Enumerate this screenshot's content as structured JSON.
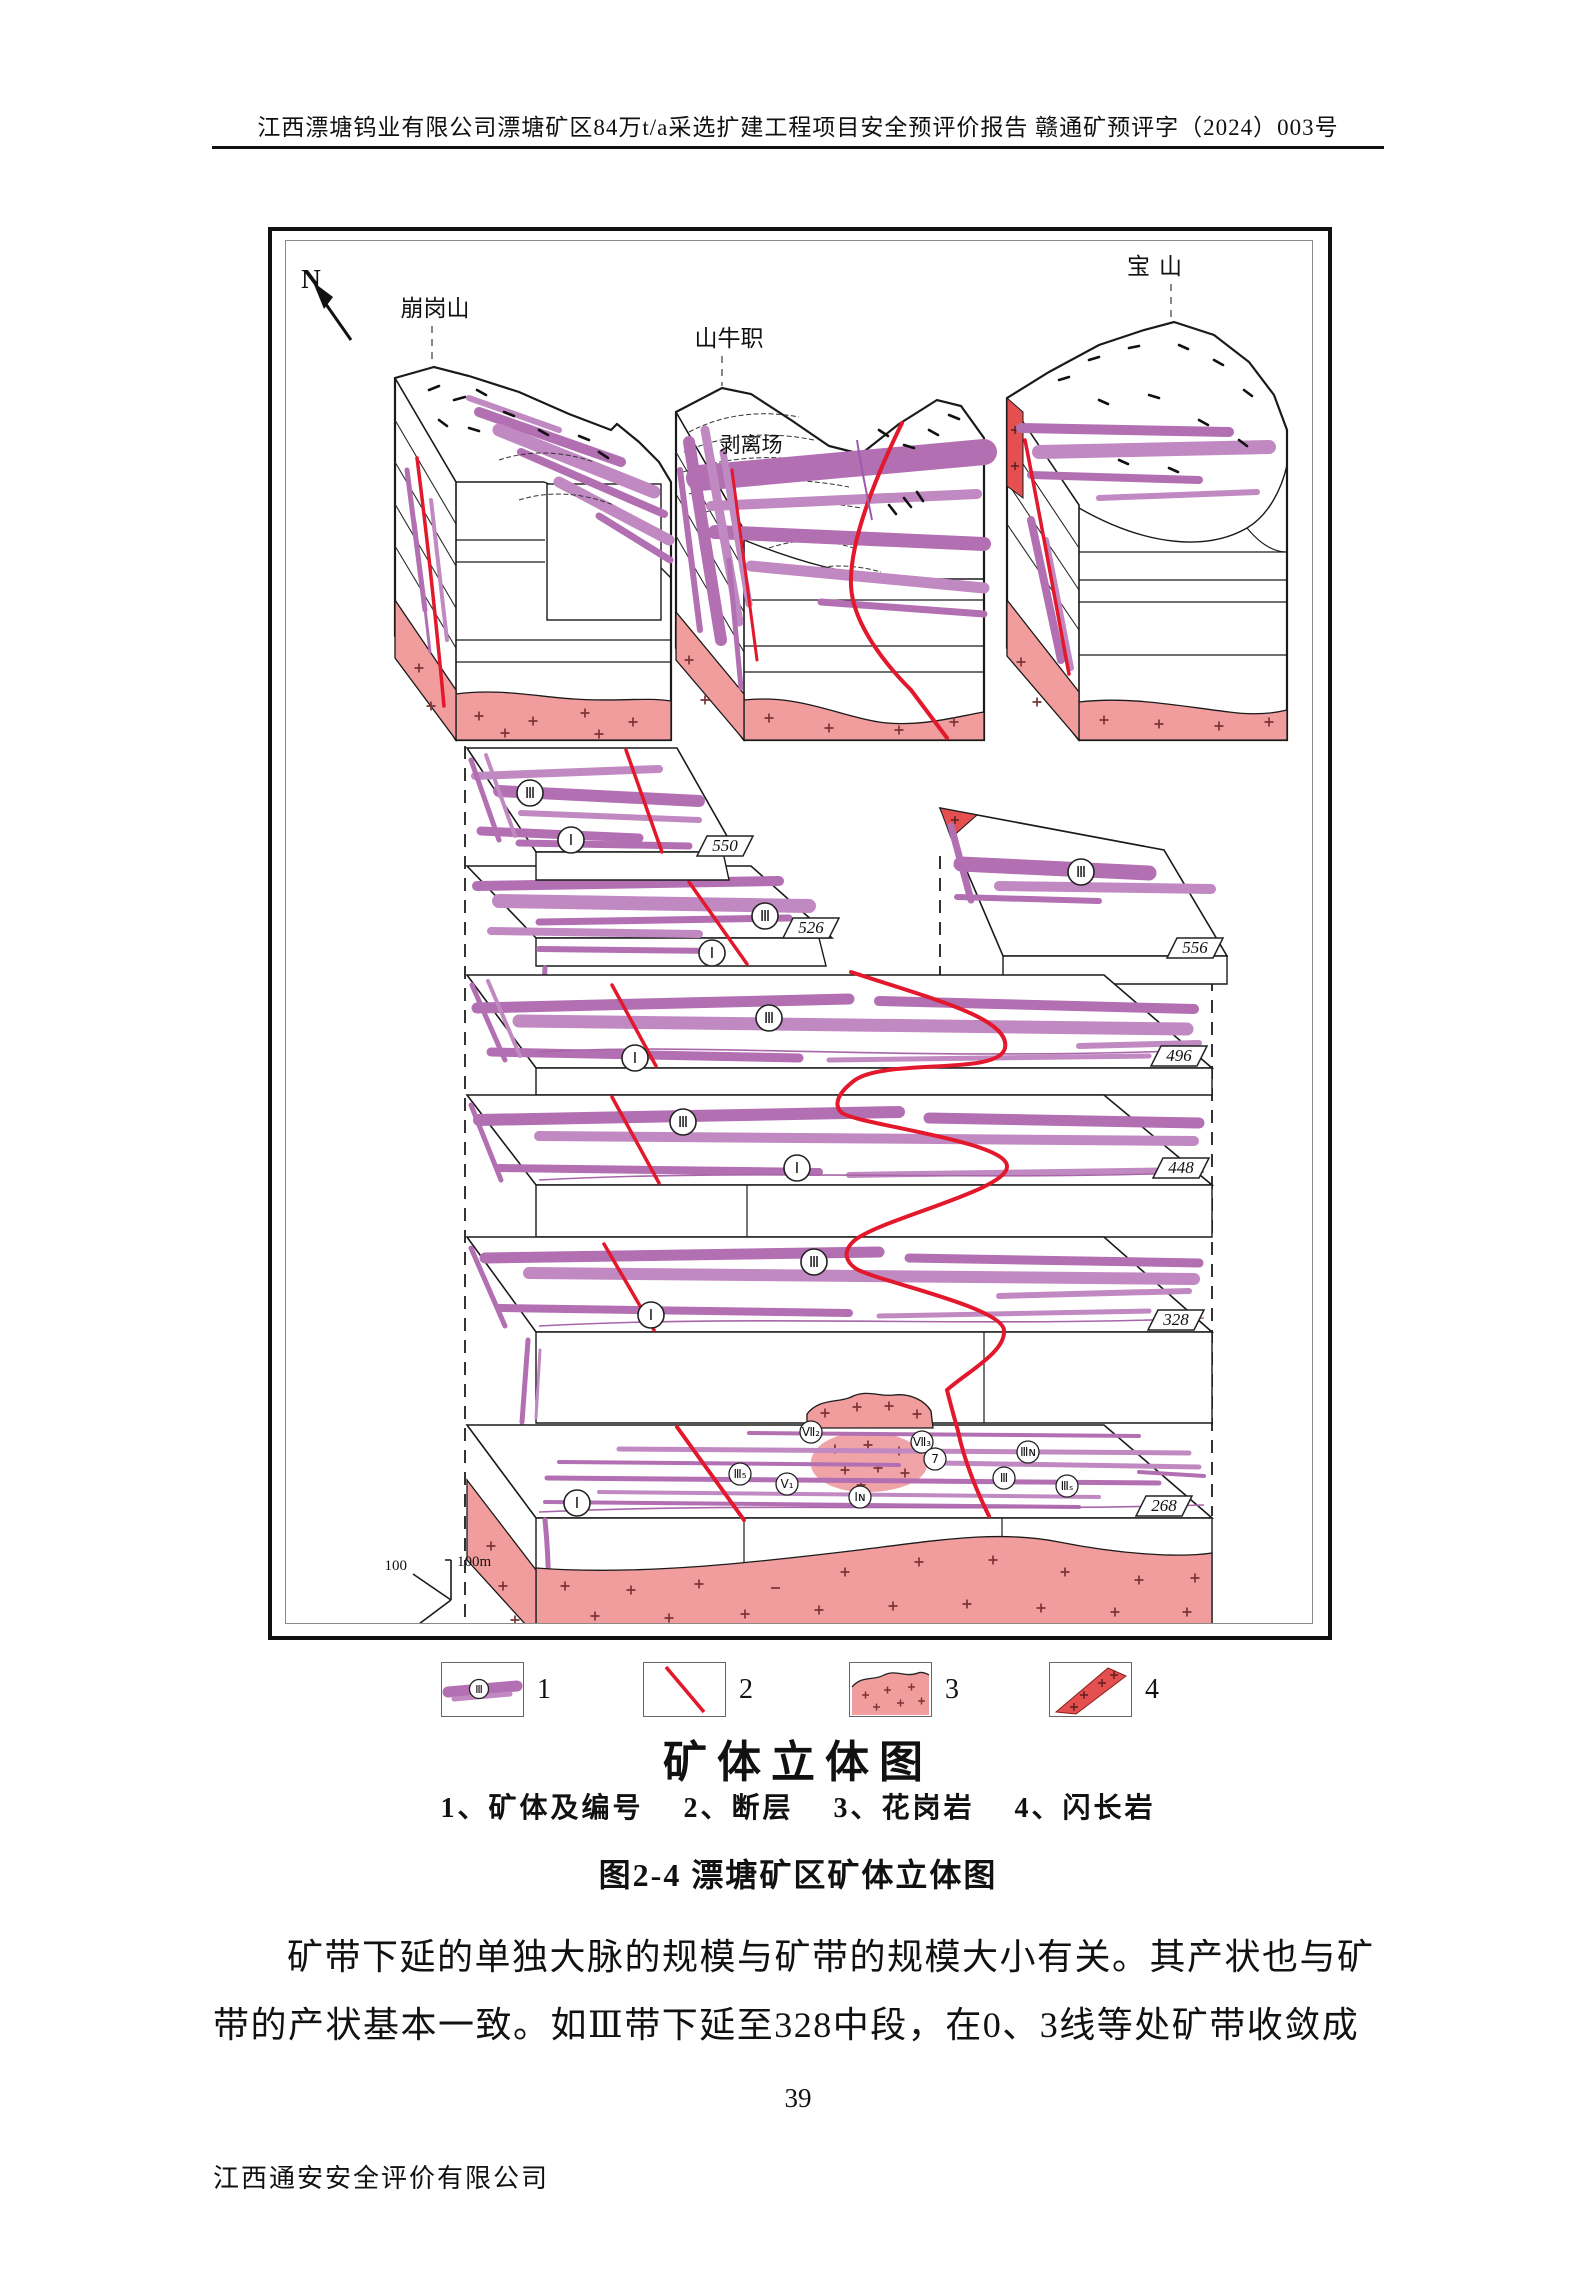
{
  "header": {
    "text": "江西漂塘钨业有限公司漂塘矿区84万t/a采选扩建工程项目安全预评价报告 赣通矿预评字（2024）003号"
  },
  "figure": {
    "north": "N",
    "mountains": [
      "崩岗山",
      "山牛职",
      "宝山"
    ],
    "stripping_site": "剥离场",
    "levels": [
      "550",
      "526",
      "556",
      "496",
      "448",
      "328",
      "268"
    ],
    "vein_ids": {
      "lv550": [
        "Ⅲ",
        "Ⅰ"
      ],
      "lv526": [
        "Ⅲ",
        "Ⅰ"
      ],
      "lv556": [
        "Ⅲ"
      ],
      "lv496": [
        "Ⅲ",
        "Ⅰ"
      ],
      "lv448": [
        "Ⅲ",
        "Ⅰ"
      ],
      "lv328": [
        "Ⅲ",
        "Ⅰ"
      ],
      "lv268": {
        "i": "Ⅰ",
        "iii5": "Ⅲ₅",
        "v1": "Ⅴ₁",
        "in": "Ⅰɴ",
        "vii2": "Ⅶ₂",
        "vii3": "Ⅶ₃",
        "q7": "7",
        "iiin": "Ⅲɴ",
        "iii": "Ⅲ",
        "iiis": "Ⅲₛ"
      }
    },
    "scale": {
      "v": "100",
      "h": "100m",
      "d": "100"
    },
    "colors": {
      "vein": "#b26fb2",
      "fault": "#e2182c",
      "granite": "#f29d9d",
      "diorite": "#e4504f"
    }
  },
  "legend": {
    "title": "矿体立体图",
    "line": "1、矿体及编号    2、断层    3、花岗岩    4、闪长岩",
    "items": [
      {
        "num": "1",
        "label": "矿体及编号"
      },
      {
        "num": "2",
        "label": "断层"
      },
      {
        "num": "3",
        "label": "花岗岩"
      },
      {
        "num": "4",
        "label": "闪长岩"
      }
    ]
  },
  "caption": "图2-4  漂塘矿区矿体立体图",
  "paragraph": {
    "line1": "矿带下延的单独大脉的规模与矿带的规模大小有关。其产状也与矿",
    "line2": "带的产状基本一致。如Ⅲ带下延至328中段，在0、3线等处矿带收敛成"
  },
  "page_number": "39",
  "footer": "江西通安安全评价有限公司"
}
